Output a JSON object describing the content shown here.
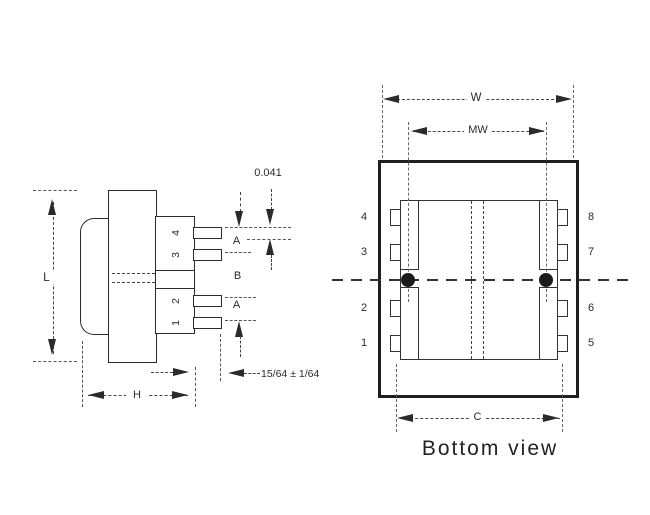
{
  "drawing": {
    "side_view": {
      "pin_labels": [
        "4",
        "3",
        "2",
        "1"
      ],
      "dimensions": {
        "height": "L",
        "width": "H",
        "pin_thickness": "0.041",
        "pin_length": "15/64 ± 1/64",
        "pin_gap_top": "A",
        "pin_gap_middle": "B",
        "pin_gap_bottom": "A"
      }
    },
    "bottom_view": {
      "title": "Bottom view",
      "left_pin_labels": [
        "4",
        "3",
        "2",
        "1"
      ],
      "right_pin_labels": [
        "8",
        "7",
        "6",
        "5"
      ],
      "dimensions": {
        "overall_width": "W",
        "mounting_width": "MW",
        "pin_row_spacing": "C"
      }
    },
    "colors": {
      "ink": "#2b2b2b",
      "background": "#ffffff"
    }
  }
}
